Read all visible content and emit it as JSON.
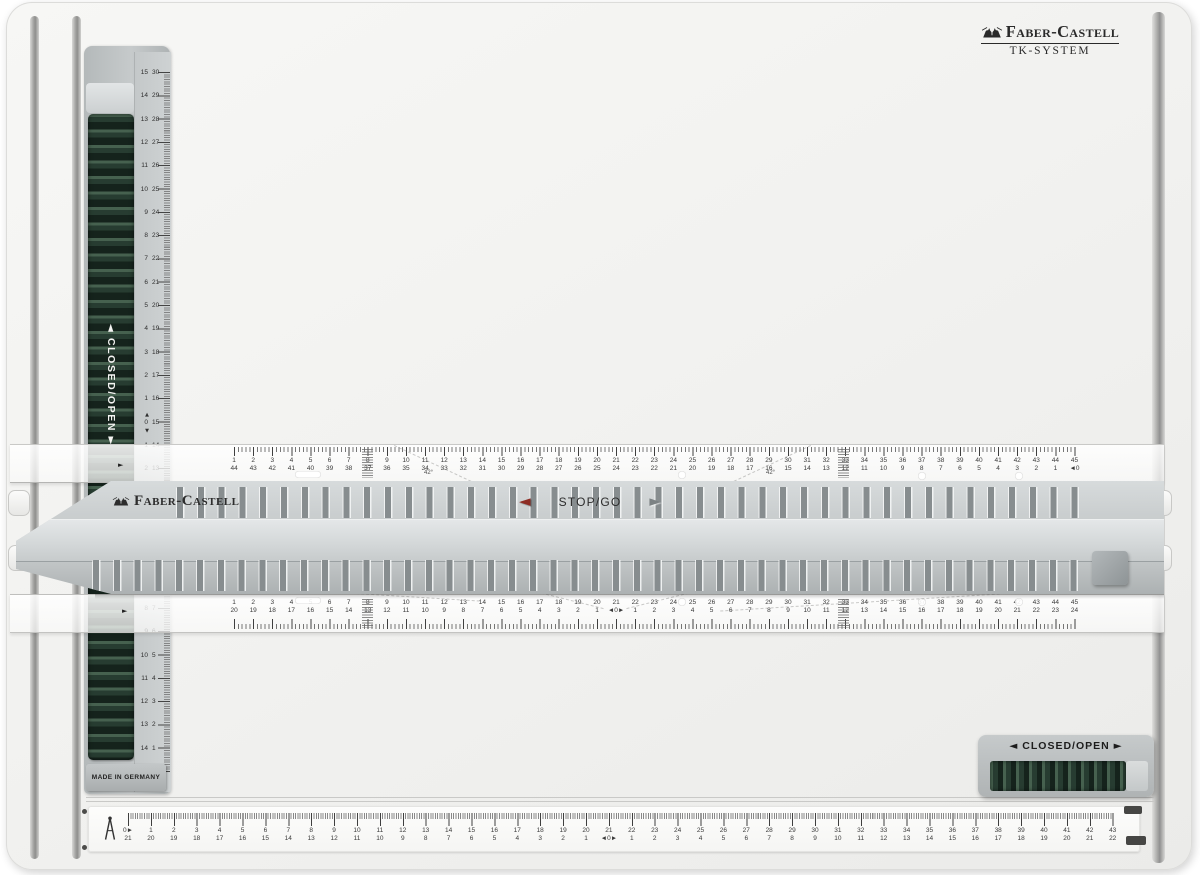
{
  "header_logo": {
    "name": "Faber-Castell",
    "system": "TK-SYSTEM"
  },
  "carriage": {
    "brand": "Faber-Castell",
    "stop_go": "STOP/GO"
  },
  "left_rail": {
    "closed_open": "CLOSED/OPEN",
    "made_in": "MADE IN GERMANY"
  },
  "bottom_clamp": {
    "closed_open": "CLOSED/OPEN"
  },
  "markers": {
    "left": "◄",
    "right": "►",
    "up": "▲",
    "down": "▼"
  },
  "angle_marks": [
    {
      "text": "42°",
      "x": 424,
      "y": 470
    },
    {
      "text": "42°",
      "x": 766,
      "y": 470
    },
    {
      "text": "7°",
      "x": 256,
      "y": 584
    },
    {
      "text": "42°",
      "x": 549,
      "y": 586
    },
    {
      "text": "42°",
      "x": 742,
      "y": 586
    },
    {
      "text": "7°",
      "x": 944,
      "y": 584
    }
  ],
  "scales": {
    "vertical": {
      "pairs": [
        [
          15,
          30
        ],
        [
          14,
          29
        ],
        [
          13,
          28
        ],
        [
          12,
          27
        ],
        [
          11,
          26
        ],
        [
          10,
          25
        ],
        [
          9,
          24
        ],
        [
          8,
          23
        ],
        [
          7,
          22
        ],
        [
          6,
          21
        ],
        [
          5,
          20
        ],
        [
          4,
          19
        ],
        [
          3,
          18
        ],
        [
          2,
          17
        ],
        [
          1,
          16
        ],
        [
          0,
          15
        ],
        [
          1,
          14
        ],
        [
          2,
          13
        ],
        [
          3,
          12
        ],
        [
          4,
          11
        ],
        [
          5,
          10
        ],
        [
          6,
          9
        ],
        [
          7,
          8
        ],
        [
          8,
          7
        ],
        [
          9,
          6
        ],
        [
          10,
          5
        ],
        [
          11,
          4
        ],
        [
          12,
          3
        ],
        [
          13,
          2
        ],
        [
          14,
          1
        ],
        [
          15,
          0
        ]
      ]
    },
    "ruler_top": {
      "pairs": [
        [
          1,
          44
        ],
        [
          2,
          43
        ],
        [
          3,
          42
        ],
        [
          4,
          41
        ],
        [
          5,
          40
        ],
        [
          6,
          39
        ],
        [
          7,
          38
        ],
        [
          8,
          37
        ],
        [
          9,
          36
        ],
        [
          10,
          35
        ],
        [
          11,
          34
        ],
        [
          12,
          33
        ],
        [
          13,
          32
        ],
        [
          14,
          31
        ],
        [
          15,
          30
        ],
        [
          16,
          29
        ],
        [
          17,
          28
        ],
        [
          18,
          27
        ],
        [
          19,
          26
        ],
        [
          20,
          25
        ],
        [
          21,
          24
        ],
        [
          22,
          23
        ],
        [
          23,
          22
        ],
        [
          24,
          21
        ],
        [
          25,
          20
        ],
        [
          26,
          19
        ],
        [
          27,
          18
        ],
        [
          28,
          17
        ],
        [
          29,
          16
        ],
        [
          30,
          15
        ],
        [
          31,
          14
        ],
        [
          32,
          13
        ],
        [
          33,
          12
        ],
        [
          34,
          11
        ],
        [
          35,
          10
        ],
        [
          36,
          9
        ],
        [
          37,
          8
        ],
        [
          38,
          7
        ],
        [
          39,
          6
        ],
        [
          40,
          5
        ],
        [
          41,
          4
        ],
        [
          42,
          3
        ],
        [
          43,
          2
        ],
        [
          44,
          1
        ],
        [
          45,
          0
        ]
      ]
    },
    "ruler_bottom": {
      "pairs": [
        [
          1,
          20
        ],
        [
          2,
          19
        ],
        [
          3,
          18
        ],
        [
          4,
          17
        ],
        [
          5,
          16
        ],
        [
          6,
          15
        ],
        [
          7,
          14
        ],
        [
          8,
          13
        ],
        [
          9,
          12
        ],
        [
          10,
          11
        ],
        [
          11,
          10
        ],
        [
          12,
          9
        ],
        [
          13,
          8
        ],
        [
          14,
          7
        ],
        [
          15,
          6
        ],
        [
          16,
          5
        ],
        [
          17,
          4
        ],
        [
          18,
          3
        ],
        [
          19,
          2
        ],
        [
          20,
          1
        ],
        [
          21,
          0
        ],
        [
          22,
          1
        ],
        [
          23,
          2
        ],
        [
          24,
          3
        ],
        [
          25,
          4
        ],
        [
          26,
          5
        ],
        [
          27,
          6
        ],
        [
          28,
          7
        ],
        [
          29,
          8
        ],
        [
          30,
          9
        ],
        [
          31,
          10
        ],
        [
          32,
          11
        ],
        [
          33,
          12
        ],
        [
          34,
          13
        ],
        [
          35,
          14
        ],
        [
          36,
          15
        ],
        [
          37,
          16
        ],
        [
          38,
          17
        ],
        [
          39,
          18
        ],
        [
          40,
          19
        ],
        [
          41,
          20
        ],
        [
          42,
          21
        ],
        [
          43,
          22
        ],
        [
          44,
          23
        ],
        [
          45,
          24
        ]
      ]
    },
    "board_bottom": {
      "pairs": [
        [
          0,
          21
        ],
        [
          1,
          20
        ],
        [
          2,
          19
        ],
        [
          3,
          18
        ],
        [
          4,
          17
        ],
        [
          5,
          16
        ],
        [
          6,
          15
        ],
        [
          7,
          14
        ],
        [
          8,
          13
        ],
        [
          9,
          12
        ],
        [
          10,
          11
        ],
        [
          11,
          10
        ],
        [
          12,
          9
        ],
        [
          13,
          8
        ],
        [
          14,
          7
        ],
        [
          15,
          6
        ],
        [
          16,
          5
        ],
        [
          17,
          4
        ],
        [
          18,
          3
        ],
        [
          19,
          2
        ],
        [
          20,
          1
        ],
        [
          21,
          0
        ],
        [
          22,
          1
        ],
        [
          23,
          2
        ],
        [
          24,
          3
        ],
        [
          25,
          4
        ],
        [
          26,
          5
        ],
        [
          27,
          6
        ],
        [
          28,
          7
        ],
        [
          29,
          8
        ],
        [
          30,
          9
        ],
        [
          31,
          10
        ],
        [
          32,
          11
        ],
        [
          33,
          12
        ],
        [
          34,
          13
        ],
        [
          35,
          14
        ],
        [
          36,
          15
        ],
        [
          37,
          16
        ],
        [
          38,
          17
        ],
        [
          39,
          18
        ],
        [
          40,
          19
        ],
        [
          41,
          20
        ],
        [
          42,
          21
        ],
        [
          43,
          22
        ]
      ]
    }
  }
}
